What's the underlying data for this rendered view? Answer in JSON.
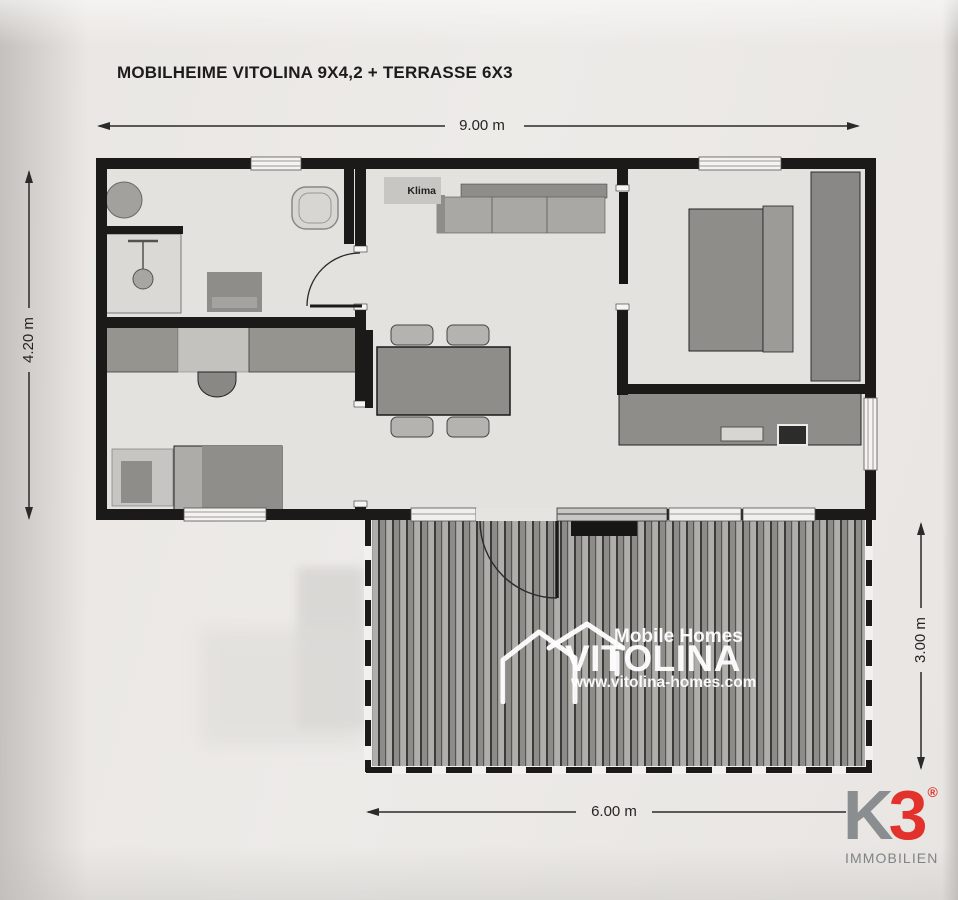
{
  "document": {
    "title": "MOBILHEIME VITOLINA 9X4,2 + TERRASSE 6X3"
  },
  "dimensions": {
    "house_width": "9.00 m",
    "house_depth": "4.20 m",
    "terrace_depth": "3.00 m",
    "terrace_width": "6.00 m"
  },
  "floorplan": {
    "klima_label": "Klima"
  },
  "watermark": {
    "tagline": "Mobile Homes",
    "brand": "VITOLINA",
    "website": "www.vitolina-homes.com"
  },
  "branding": {
    "logo_k": "K",
    "logo_3": "3",
    "registered": "®",
    "subtitle": "IMMOBILIEN",
    "colors": {
      "red": "#e2322b",
      "gray": "#8b8e90"
    }
  },
  "palette": {
    "paper": "#ebe8e5",
    "wall": "#1b1a18",
    "floor": "#e4e2df",
    "furniture_dark": "#8f8d8a",
    "furniture_light": "#c6c4c1",
    "deck_plank_light": "#b0aeab",
    "deck_plank_dark": "#8e8c89"
  }
}
